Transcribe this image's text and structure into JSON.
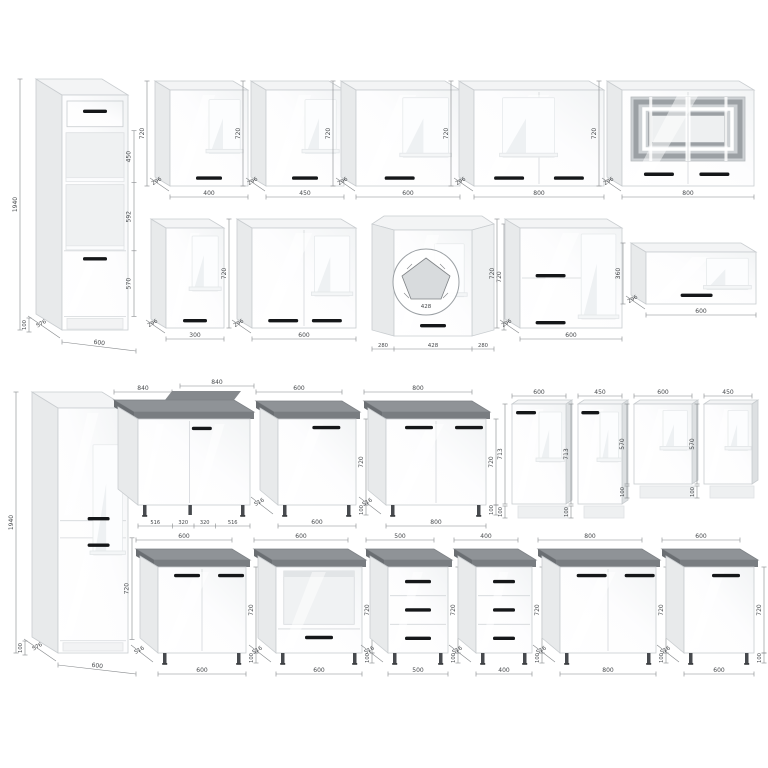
{
  "colors": {
    "face_stroke": "#c9cdd0",
    "side": "#e8eaeb",
    "side_dark": "#dde0e2",
    "top": "#f3f4f5",
    "counter_top": "#8f9397",
    "counter_edge": "#797d81",
    "counter_side": "#6a6e72",
    "handle": "#151719",
    "dim_line": "#85888b",
    "dim_text": "#46494c",
    "niche": "#eff1f2",
    "glass_bg": "#cdd1d4",
    "glass_band": "#9ba0a4",
    "leg": "#474a4e"
  },
  "cabinets": [
    {
      "name": "tall-oven-housing-600",
      "type": "tall",
      "variant": "oven",
      "x": 62,
      "y": 95,
      "w": 66,
      "h": 235,
      "dx": 26,
      "dy": 16,
      "secFr": [
        0.152,
        0.373,
        0.663,
        0.942
      ],
      "handles": [
        [
          0.5,
          0.062,
          24
        ],
        [
          0.5,
          0.69,
          24
        ]
      ],
      "dims": [
        {
          "k": "height_left",
          "v": "1940"
        },
        {
          "k": "plinth",
          "v": "100"
        },
        {
          "k": "depth",
          "v": "576"
        },
        {
          "k": "width",
          "v": "600"
        },
        {
          "k": "sec",
          "v": "450"
        },
        {
          "k": "sec",
          "v": "592"
        },
        {
          "k": "sec",
          "v": "570"
        }
      ]
    },
    {
      "name": "wall-cabinet-400",
      "type": "wall",
      "doors": 1,
      "x": 170,
      "y": 90,
      "w": 78,
      "h": 96,
      "dx": 15,
      "dy": 9,
      "win": [
        0.5,
        0.1,
        0.4,
        0.56
      ],
      "handles": [
        [
          0.5,
          0.9,
          26
        ]
      ],
      "dims": [
        {
          "k": "height_left",
          "v": "720"
        },
        {
          "k": "depth",
          "v": "296"
        },
        {
          "k": "width",
          "v": "400"
        }
      ]
    },
    {
      "name": "wall-cabinet-450",
      "type": "wall",
      "doors": 1,
      "x": 266,
      "y": 90,
      "w": 78,
      "h": 96,
      "dx": 15,
      "dy": 9,
      "win": [
        0.5,
        0.1,
        0.4,
        0.56
      ],
      "handles": [
        [
          0.5,
          0.9,
          26
        ]
      ],
      "dims": [
        {
          "k": "height_left",
          "v": "720"
        },
        {
          "k": "depth",
          "v": "296"
        },
        {
          "k": "width",
          "v": "450"
        }
      ]
    },
    {
      "name": "wall-cabinet-600",
      "type": "wall",
      "doors": 1,
      "x": 356,
      "y": 90,
      "w": 104,
      "h": 96,
      "dx": 15,
      "dy": 9,
      "win": [
        0.45,
        0.08,
        0.44,
        0.62
      ],
      "handles": [
        [
          0.42,
          0.9,
          30
        ]
      ],
      "dims": [
        {
          "k": "height_left",
          "v": "720"
        },
        {
          "k": "depth",
          "v": "296"
        },
        {
          "k": "width",
          "v": "600"
        }
      ]
    },
    {
      "name": "wall-cabinet-800-double",
      "type": "wall",
      "doors": 2,
      "x": 474,
      "y": 90,
      "w": 130,
      "h": 96,
      "dx": 15,
      "dy": 9,
      "win": [
        0.22,
        0.08,
        0.4,
        0.62
      ],
      "handles": [
        [
          0.27,
          0.9,
          30
        ],
        [
          0.73,
          0.9,
          30
        ]
      ],
      "dims": [
        {
          "k": "height_left",
          "v": "720"
        },
        {
          "k": "depth",
          "v": "296"
        },
        {
          "k": "width",
          "v": "800"
        }
      ]
    },
    {
      "name": "wall-cabinet-glass-800",
      "type": "glass",
      "x": 622,
      "y": 90,
      "w": 132,
      "h": 96,
      "dx": 15,
      "dy": 9,
      "handles": [
        [
          0.28,
          0.86,
          30
        ],
        [
          0.7,
          0.86,
          30
        ]
      ],
      "dims": [
        {
          "k": "height_left",
          "v": "720"
        },
        {
          "k": "depth",
          "v": "296"
        },
        {
          "k": "width",
          "v": "800"
        }
      ]
    },
    {
      "name": "wall-cabinet-300",
      "type": "wall",
      "doors": 1,
      "x": 166,
      "y": 228,
      "w": 58,
      "h": 100,
      "dx": 15,
      "dy": 9,
      "win": [
        0.45,
        0.08,
        0.45,
        0.55
      ],
      "handles": [
        [
          0.5,
          0.91,
          24
        ]
      ],
      "dims": [
        {
          "k": "depth",
          "v": "296"
        },
        {
          "k": "width",
          "v": "300"
        }
      ]
    },
    {
      "name": "wall-cabinet-600-double",
      "type": "wall",
      "doors": 2,
      "x": 252,
      "y": 228,
      "w": 104,
      "h": 100,
      "dx": 15,
      "dy": 9,
      "win": [
        0.6,
        0.08,
        0.34,
        0.6
      ],
      "handles": [
        [
          0.3,
          0.91,
          30
        ],
        [
          0.72,
          0.91,
          30
        ]
      ],
      "dims": [
        {
          "k": "height_left",
          "v": "720"
        },
        {
          "k": "depth",
          "v": "296"
        },
        {
          "k": "width",
          "v": "600"
        }
      ]
    },
    {
      "name": "wall-corner-cabinet-428",
      "type": "wallcorner",
      "x": 372,
      "y": 224,
      "handles": [
        [
          0.5,
          0.89,
          26
        ]
      ],
      "dims": [
        {
          "k": "height_right",
          "v": "720"
        },
        {
          "k": "w_left",
          "v": "280"
        },
        {
          "k": "width",
          "v": "428"
        },
        {
          "k": "w_right",
          "v": "280"
        },
        {
          "k": "plan",
          "v": "428"
        }
      ]
    },
    {
      "name": "wall-flap-cabinet-600-double",
      "type": "wallflap",
      "flaps": 2,
      "x": 520,
      "y": 228,
      "w": 102,
      "h": 100,
      "dx": 15,
      "dy": 9,
      "win": [
        0.6,
        0.06,
        0.34,
        0.85
      ],
      "handles": [
        [
          0.3,
          0.46,
          30
        ],
        [
          0.3,
          0.93,
          30
        ]
      ],
      "dims": [
        {
          "k": "height_left",
          "v": "720"
        },
        {
          "k": "depth",
          "v": "296"
        },
        {
          "k": "width",
          "v": "600"
        }
      ]
    },
    {
      "name": "wall-flap-cabinet-600x360",
      "type": "wallflap",
      "flaps": 1,
      "x": 646,
      "y": 252,
      "w": 110,
      "h": 52,
      "dx": 15,
      "dy": 9,
      "win": [
        0.55,
        0.12,
        0.38,
        0.6
      ],
      "handles": [
        [
          0.46,
          0.8,
          32
        ]
      ],
      "dims": [
        {
          "k": "height_left",
          "v": "360"
        },
        {
          "k": "depth",
          "v": "296"
        },
        {
          "k": "width",
          "v": "600"
        }
      ]
    },
    {
      "name": "tall-pantry-600",
      "type": "tall",
      "variant": "pantry",
      "x": 58,
      "y": 408,
      "w": 70,
      "h": 245,
      "dx": 26,
      "dy": 16,
      "secFr": [
        0.53,
        0.945
      ],
      "handles": [
        [
          0.58,
          0.445,
          22
        ],
        [
          0.58,
          0.553,
          22
        ]
      ],
      "dims": [
        {
          "k": "height_left",
          "v": "1940"
        },
        {
          "k": "plinth",
          "v": "100"
        },
        {
          "k": "depth",
          "v": "576"
        },
        {
          "k": "width",
          "v": "600"
        },
        {
          "k": "sec_single",
          "v": "720"
        }
      ]
    },
    {
      "name": "base-corner-cabinet-840",
      "type": "basecorner",
      "x": 138,
      "y": 412,
      "w": 112,
      "h": 86,
      "dx": 20,
      "dy": 12,
      "handles": [
        [
          0.57,
          0.09,
          20
        ]
      ],
      "dims": [
        {
          "k": "top_left",
          "v": "840"
        },
        {
          "k": "top_right",
          "v": "840"
        },
        {
          "k": "b4a",
          "v": "516"
        },
        {
          "k": "b4b",
          "v": "320"
        },
        {
          "k": "b4c",
          "v": "320"
        },
        {
          "k": "b4d",
          "v": "516"
        }
      ]
    },
    {
      "name": "base-cabinet-600",
      "type": "base",
      "doors": 1,
      "x": 278,
      "y": 412,
      "w": 78,
      "h": 86,
      "dx": 18,
      "dy": 11,
      "handles": [
        [
          0.62,
          0.08,
          28
        ]
      ],
      "dims": [
        {
          "k": "width_top",
          "v": "600"
        },
        {
          "k": "depth",
          "v": "516"
        },
        {
          "k": "width",
          "v": "600"
        },
        {
          "k": "height_right",
          "v": "720"
        },
        {
          "k": "legs",
          "v": "100"
        }
      ]
    },
    {
      "name": "base-cabinet-800-double",
      "type": "base",
      "doors": 2,
      "x": 386,
      "y": 412,
      "w": 100,
      "h": 86,
      "dx": 18,
      "dy": 11,
      "handles": [
        [
          0.33,
          0.08,
          28
        ],
        [
          0.83,
          0.08,
          28
        ]
      ],
      "dims": [
        {
          "k": "width_top",
          "v": "800"
        },
        {
          "k": "depth",
          "v": "516"
        },
        {
          "k": "width",
          "v": "800"
        },
        {
          "k": "height_right",
          "v": "720"
        },
        {
          "k": "legs",
          "v": "100"
        }
      ]
    },
    {
      "name": "appliance-panel-600x713",
      "type": "panel",
      "x": 512,
      "y": 404,
      "w": 54,
      "h": 100,
      "handles": [
        [
          0.26,
          0.07,
          20
        ]
      ],
      "dims": [
        {
          "k": "width_top",
          "v": "600"
        },
        {
          "k": "height_left",
          "v": "713"
        },
        {
          "k": "plinth",
          "v": "100"
        }
      ]
    },
    {
      "name": "appliance-panel-450x713",
      "type": "panel",
      "x": 578,
      "y": 404,
      "w": 44,
      "h": 100,
      "handles": [
        [
          0.28,
          0.07,
          18
        ]
      ],
      "dims": [
        {
          "k": "width_top",
          "v": "450"
        },
        {
          "k": "height_left",
          "v": "713"
        },
        {
          "k": "plinth",
          "v": "100"
        }
      ]
    },
    {
      "name": "appliance-panel-600x570",
      "type": "panel",
      "x": 634,
      "y": 404,
      "w": 58,
      "h": 80,
      "handles": [],
      "dims": [
        {
          "k": "width_top",
          "v": "600"
        },
        {
          "k": "height_left",
          "v": "570"
        },
        {
          "k": "plinth",
          "v": "100"
        }
      ]
    },
    {
      "name": "appliance-panel-450x570",
      "type": "panel",
      "x": 704,
      "y": 404,
      "w": 48,
      "h": 80,
      "handles": [],
      "dims": [
        {
          "k": "width_top",
          "v": "450"
        },
        {
          "k": "height_left",
          "v": "570"
        },
        {
          "k": "plinth",
          "v": "100"
        }
      ]
    },
    {
      "name": "base-cabinet-600-double",
      "type": "base",
      "doors": 2,
      "x": 158,
      "y": 560,
      "w": 88,
      "h": 86,
      "dx": 18,
      "dy": 11,
      "handles": [
        [
          0.33,
          0.08,
          26
        ],
        [
          0.83,
          0.08,
          26
        ]
      ],
      "dims": [
        {
          "k": "width_top",
          "v": "600"
        },
        {
          "k": "depth",
          "v": "516"
        },
        {
          "k": "width",
          "v": "600"
        },
        {
          "k": "height_right",
          "v": "720"
        },
        {
          "k": "legs",
          "v": "100"
        }
      ]
    },
    {
      "name": "base-oven-cabinet-600",
      "type": "baseoven",
      "x": 276,
      "y": 560,
      "w": 86,
      "h": 86,
      "dx": 18,
      "dy": 11,
      "handles": [
        [
          0.5,
          0.8,
          28
        ]
      ],
      "dims": [
        {
          "k": "width_top",
          "v": "600"
        },
        {
          "k": "depth",
          "v": "516"
        },
        {
          "k": "width",
          "v": "600"
        },
        {
          "k": "height_right",
          "v": "720"
        },
        {
          "k": "legs",
          "v": "100"
        }
      ]
    },
    {
      "name": "drawer-base-cabinet-500",
      "type": "basedrawers",
      "x": 388,
      "y": 560,
      "w": 60,
      "h": 86,
      "dx": 18,
      "dy": 11,
      "handles": [
        [
          0.5,
          0.15,
          26
        ],
        [
          0.5,
          0.48,
          26
        ],
        [
          0.5,
          0.81,
          26
        ]
      ],
      "dims": [
        {
          "k": "width_top",
          "v": "500"
        },
        {
          "k": "depth",
          "v": "516"
        },
        {
          "k": "width",
          "v": "500"
        },
        {
          "k": "height_right",
          "v": "720"
        },
        {
          "k": "legs",
          "v": "100"
        }
      ]
    },
    {
      "name": "drawer-base-cabinet-400",
      "type": "basedrawers",
      "x": 476,
      "y": 560,
      "w": 56,
      "h": 86,
      "dx": 18,
      "dy": 11,
      "handles": [
        [
          0.5,
          0.15,
          22
        ],
        [
          0.5,
          0.48,
          22
        ],
        [
          0.5,
          0.81,
          22
        ]
      ],
      "dims": [
        {
          "k": "width_top",
          "v": "400"
        },
        {
          "k": "depth",
          "v": "516"
        },
        {
          "k": "width",
          "v": "400"
        },
        {
          "k": "height_right",
          "v": "720"
        },
        {
          "k": "legs",
          "v": "100"
        }
      ]
    },
    {
      "name": "base-cabinet-800-double-2",
      "type": "base",
      "doors": 2,
      "x": 560,
      "y": 560,
      "w": 96,
      "h": 86,
      "dx": 18,
      "dy": 11,
      "handles": [
        [
          0.33,
          0.08,
          30
        ],
        [
          0.83,
          0.08,
          30
        ]
      ],
      "dims": [
        {
          "k": "width_top",
          "v": "800"
        },
        {
          "k": "depth",
          "v": "516"
        },
        {
          "k": "width",
          "v": "800"
        },
        {
          "k": "height_right",
          "v": "720"
        },
        {
          "k": "legs",
          "v": "100"
        }
      ]
    },
    {
      "name": "base-cabinet-600-single",
      "type": "base",
      "doors": 1,
      "x": 684,
      "y": 560,
      "w": 70,
      "h": 86,
      "dx": 18,
      "dy": 11,
      "handles": [
        [
          0.6,
          0.08,
          28
        ]
      ],
      "dims": [
        {
          "k": "width_top",
          "v": "600"
        },
        {
          "k": "depth",
          "v": "516"
        },
        {
          "k": "width",
          "v": "600"
        },
        {
          "k": "height_right",
          "v": "720"
        },
        {
          "k": "legs",
          "v": "100"
        }
      ]
    }
  ]
}
